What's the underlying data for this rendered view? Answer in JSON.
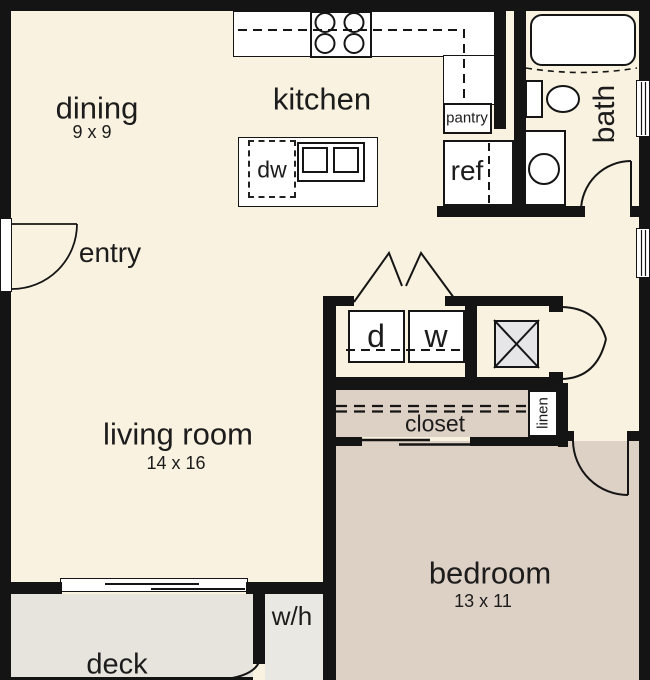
{
  "rooms": {
    "dining": {
      "label": "dining",
      "dims": "9 x 9"
    },
    "kitchen": {
      "label": "kitchen"
    },
    "entry": {
      "label": "entry"
    },
    "bath": {
      "label": "bath"
    },
    "living_room": {
      "label": "living room",
      "dims": "14 x 16"
    },
    "bedroom": {
      "label": "bedroom",
      "dims": "13 x 11"
    },
    "closet": {
      "label": "closet"
    },
    "linen": {
      "label": "linen"
    },
    "deck": {
      "label": "deck"
    },
    "pantry": {
      "label": "pantry"
    },
    "water_heater": {
      "label": "w/h"
    }
  },
  "fixtures": {
    "dishwasher": {
      "label": "dw"
    },
    "refrigerator": {
      "label": "ref"
    },
    "dryer": {
      "label": "d"
    },
    "washer": {
      "label": "w"
    }
  },
  "colors": {
    "floor_main": "#f9f2e0",
    "floor_bedroom": "#ddd0c5",
    "floor_deck": "#e7e4de",
    "wall": "#141414",
    "fixture_fill": "#ffffff",
    "hvac_fill": "#e6e6e8"
  }
}
